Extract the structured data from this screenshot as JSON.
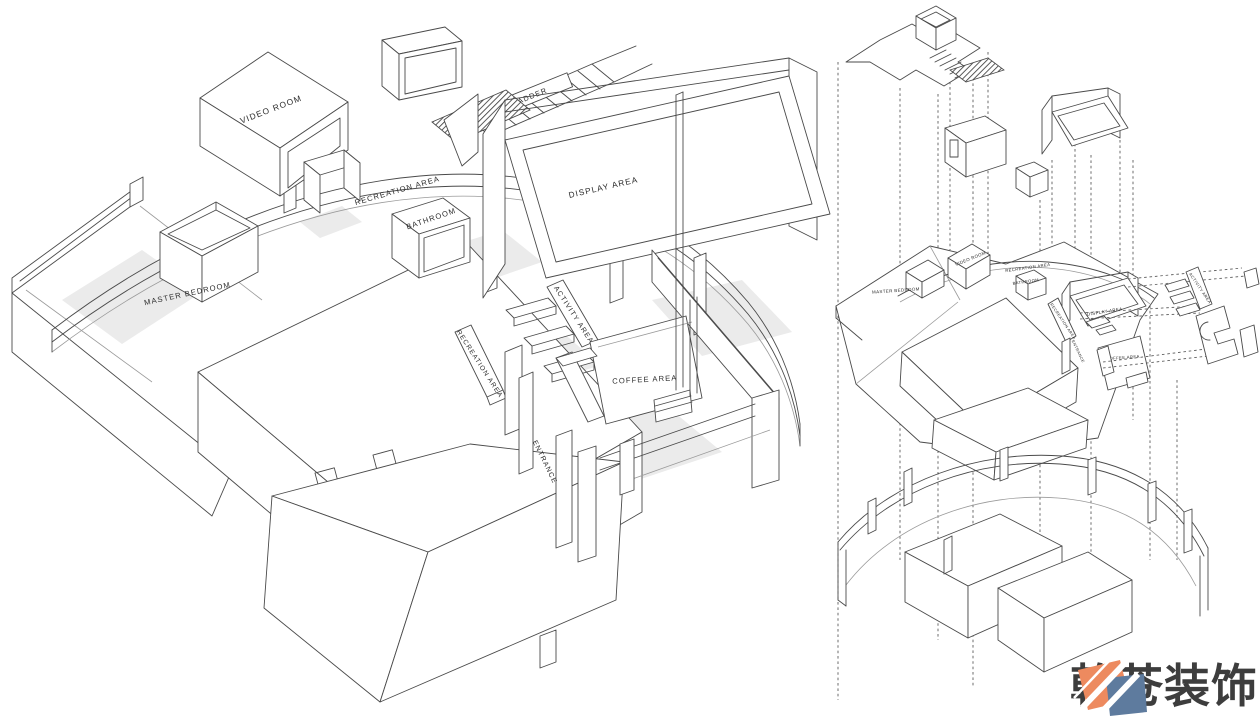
{
  "document": {
    "type": "axonometric interior design diagram",
    "background": "#ffffff"
  },
  "style": {
    "line_color": "#4a4a4a",
    "light_line_color": "#9a9a9a",
    "shadow_color": "#ebebeb",
    "label_color": "#2b2b2b"
  },
  "left_diagram": {
    "title": "assembled axonometric plan",
    "labels": {
      "video_room": "VIDEO ROOM",
      "ladder": "LADDER",
      "recreation_area": "RECREATION AREA",
      "bathroom": "BATHROOM",
      "display_area": "DISPLAY AREA",
      "master_bedroom": "MASTER BEDROOM",
      "activity_area": "ACTIVITY AREA",
      "recreation_area_bench": "RECREATION AREA",
      "coffee_area": "COFFEE AREA",
      "entrance": "ENTRANCE"
    }
  },
  "right_diagram": {
    "title": "exploded axonometric",
    "labels": {
      "master_bedroom": "MASTER BEDROOM",
      "video_room": "VIDEO ROOM",
      "recreation_area": "RECREATION AREA",
      "bathroom": "BATHROOM",
      "display_area": "DISPLAY AREA",
      "recreation_area_bench": "RECREATION AREA",
      "entrance": "ENTRANCE",
      "coffee_area": "COFFEE AREA",
      "activity_area": "ACTIVITY AREA"
    }
  },
  "logo": {
    "text": "乾苍装饰",
    "colors": {
      "orange": "#ED8A5F",
      "blue": "#5E7B9E",
      "stripe": "#FFFFFF",
      "text": "#3D3D3D"
    }
  }
}
